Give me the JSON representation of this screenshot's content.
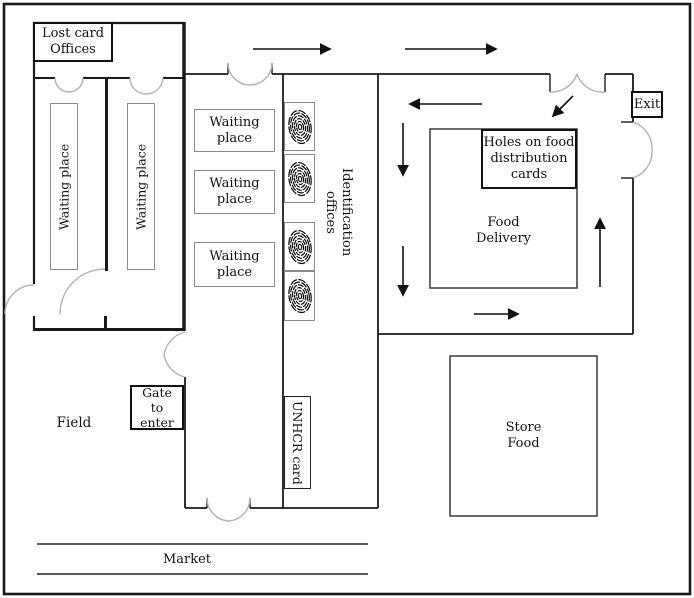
{
  "figure": {
    "type": "facility-floor-plan",
    "background_color": "#ffffff",
    "wall_color": "#1a1a1a",
    "door_arc_color": "#b3b3b3",
    "labels": {
      "lost_card_offices": "Lost card\nOffices",
      "waiting_place_column_1": "Waiting place",
      "waiting_place_column_2": "Waiting place",
      "waiting_place_room_1": "Waiting\nplace",
      "waiting_place_room_2": "Waiting\nplace",
      "waiting_place_room_3": "Waiting\nplace",
      "identification_offices": "Identification\noffices",
      "unhcr_card": "UNHCR card",
      "holes_on_food_distribution_cards": "Holes on food\ndistribution\ncards",
      "food_delivery": "Food\nDelivery",
      "exit": "Exit",
      "store_food": "Store\nFood",
      "gate_to_enter": "Gate\nto enter",
      "field": "Field",
      "market": "Market"
    },
    "fingerprint_scanner_count": 4
  }
}
